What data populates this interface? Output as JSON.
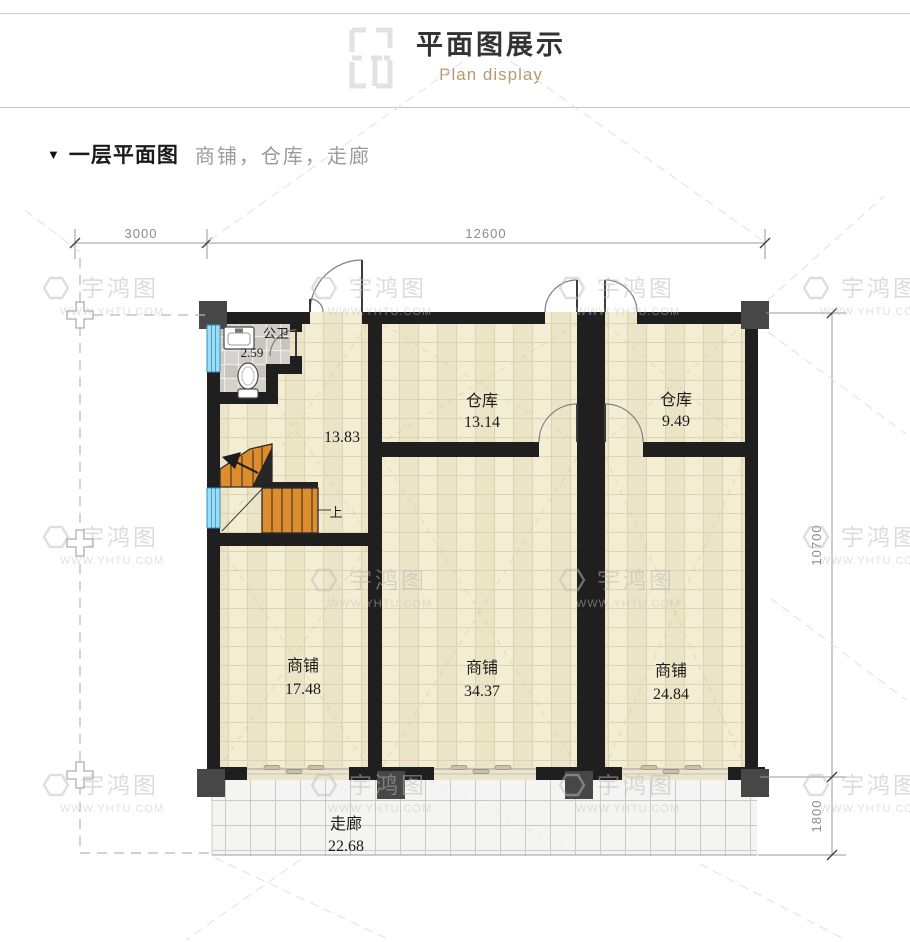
{
  "header": {
    "title": "平面图展示",
    "subtitle": "Plan display"
  },
  "section": {
    "marker": "▼",
    "title": "一层平面图",
    "subtitle": "商铺，仓库，走廊"
  },
  "watermark": {
    "brand": "宇鸿图",
    "url": "WWW.YHTU.COM"
  },
  "plan": {
    "dimensions": {
      "top_left": "3000",
      "top_span": "12600",
      "right_main": "10700",
      "right_corridor": "1800"
    },
    "stairs_up_label": "上",
    "rooms": {
      "bathroom": {
        "name": "公卫",
        "area": "2.59"
      },
      "stair_hall": {
        "area": "13.83"
      },
      "warehouse_1": {
        "name": "仓库",
        "area": "13.14"
      },
      "warehouse_2": {
        "name": "仓库",
        "area": "9.49"
      },
      "shop_1": {
        "name": "商铺",
        "area": "17.48"
      },
      "shop_2": {
        "name": "商铺",
        "area": "34.37"
      },
      "shop_3": {
        "name": "商铺",
        "area": "24.84"
      },
      "corridor": {
        "name": "走廊",
        "area": "22.68"
      }
    },
    "colors": {
      "wall": "#1f1f1f",
      "pillar": "#474747",
      "floor_tile": "#f3edd4",
      "bath_tile": "#d6d2cb",
      "corridor_tile": "#f4f4f3",
      "stair": "#dd8c2e",
      "window": "#9fdcf4",
      "subtitle_accent": "#b49a6e"
    }
  }
}
